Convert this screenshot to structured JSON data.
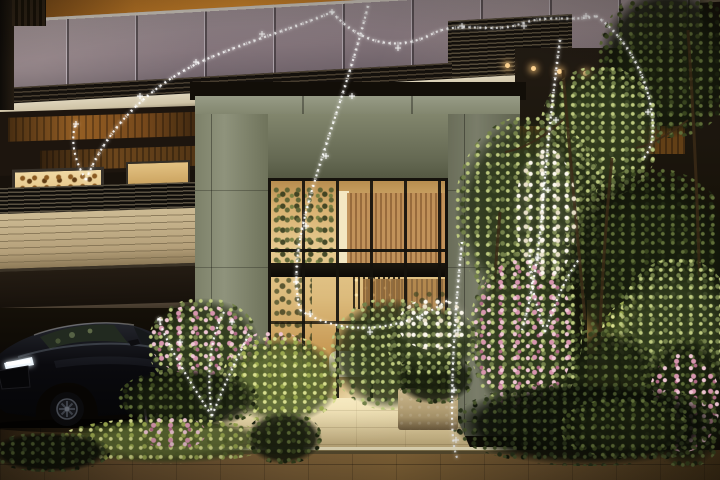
{
  "meta": {
    "kind": "architectural CG rendering, no text",
    "description": "Dusk view of a residential building entrance: tall glass lobby in a stone portal frame, warm interior light, black sedan at left driveway, flowering garden and trees, white sparkle garland illustration overlaid"
  },
  "palette": {
    "amber": "#c57d28",
    "amberDeep": "#7a4a16",
    "glass": "#8d7d84",
    "glassDk": "#6b5f66",
    "slatHi": "#564c3a",
    "slatDk": "#14100c",
    "cream": "#ded4bb",
    "creamDk": "#968a70",
    "conc": "#979b86",
    "concDk": "#636751",
    "colHi": "#8f937c",
    "colDk": "#6f735b",
    "bronze": "#9c6326",
    "brick": "#cdbb94",
    "brickDk": "#8d7a58",
    "gold": "#e6c98f",
    "goldDk": "#b9904e",
    "wood": "#c09058",
    "woodDk": "#95683a",
    "mull": "#15120c",
    "leafHi": "#bdc97e",
    "leaf": "#73814a",
    "leafDk": "#3c4726",
    "leafDeep": "#232b15",
    "pink": "#d795ae",
    "pinkHi": "#f0c6d4",
    "pave": "#8a6a3e",
    "paveDk": "#3f301b",
    "path": "#ecdcb0",
    "step": "#fdf3cd",
    "car": "#0a0a0e",
    "lamp": "#ffd490",
    "white": "#ffffff"
  },
  "scene": {
    "building": {
      "label": "apartment building facade at dusk with glass balustrades and louvers"
    },
    "balcony": {
      "label": "upper balcony with smoked glass panels and amber lit ceiling"
    },
    "portal": {
      "label": "stone portal frame around entrance"
    },
    "entrance": {
      "label": "double height glass entrance lobby with warm light and pendant fixture"
    },
    "lounge": {
      "label": "lobby lounge seat"
    },
    "car": {
      "label": "black luxury sedan with lit headlight"
    },
    "garden": {
      "label": "garden with pink blossoms, shrubs and trees"
    },
    "window": {
      "label": "warm lit garden window behind trees"
    },
    "walkway": {
      "label": "stone entrance walkway and sidewalk"
    },
    "garland": {
      "label": "hand drawn white sparkle garland overlay"
    }
  }
}
